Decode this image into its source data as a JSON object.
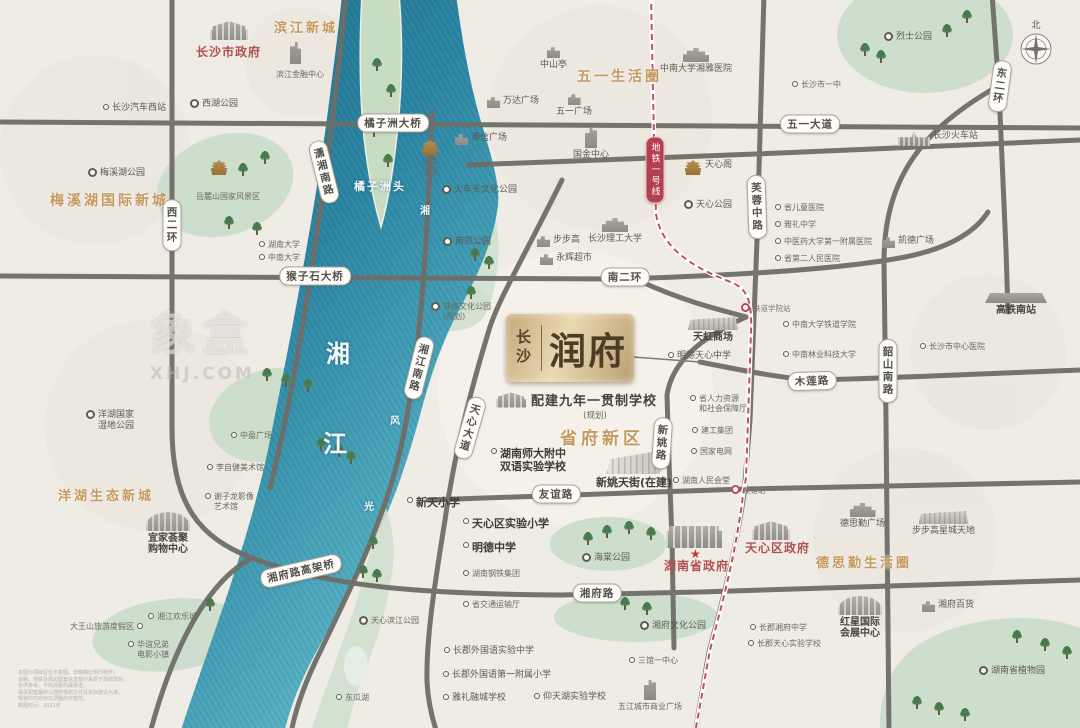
{
  "map": {
    "compass_label": "北",
    "watermark": {
      "line1": "象盒",
      "line2": "XHJ.COM"
    },
    "metro_badge": {
      "label": "地铁一号线",
      "x": 655,
      "y": 170
    },
    "project": {
      "city": "长沙",
      "name": "润府",
      "school_note": "配建九年一贯制学校",
      "school_note_sub": "(规划)",
      "district": "省府新区"
    },
    "colors": {
      "accent_gold": "#c49a5e",
      "gov_red": "#b05252",
      "road_gray": "#6f6d68",
      "river_deep": "#1b6c89",
      "river_light": "#63bccb",
      "park_green": "#cddfcc",
      "metro_red": "#c34f5e",
      "logo_gold": "#ead9b2"
    },
    "area_labels": [
      {
        "t": "滨江新城",
        "x": 274,
        "y": 17,
        "fs": 13
      },
      {
        "t": "五一生活圈",
        "x": 577,
        "y": 66,
        "fs": 14
      },
      {
        "t": "梅溪湖国际新城",
        "x": 50,
        "y": 190,
        "fs": 14
      },
      {
        "t": "洋湖生态新城",
        "x": 58,
        "y": 485,
        "fs": 13
      },
      {
        "t": "德思勤生活圈",
        "x": 816,
        "y": 552,
        "fs": 13
      }
    ],
    "river_labels": [
      {
        "t": "湘",
        "x": 326,
        "y": 334,
        "fs": 24
      },
      {
        "t": "江",
        "x": 323,
        "y": 424,
        "fs": 24
      },
      {
        "t": "橘子洲头",
        "x": 354,
        "y": 178,
        "fs": 11
      },
      {
        "t": "湘",
        "x": 420,
        "y": 202,
        "fs": 10
      },
      {
        "t": "风",
        "x": 390,
        "y": 412,
        "fs": 10
      },
      {
        "t": "光",
        "x": 364,
        "y": 498,
        "fs": 10
      }
    ],
    "road_pills": [
      {
        "t": "西二环",
        "x": 172,
        "y": 225,
        "v": 1,
        "r": 0
      },
      {
        "t": "潇湘南路",
        "x": 324,
        "y": 172,
        "v": 1,
        "r": -14
      },
      {
        "t": "橘子洲大桥",
        "x": 393,
        "y": 123,
        "v": 0,
        "r": 0
      },
      {
        "t": "五一大道",
        "x": 810,
        "y": 124,
        "v": 0,
        "r": 0
      },
      {
        "t": "东二环",
        "x": 1000,
        "y": 86,
        "v": 1,
        "r": 8
      },
      {
        "t": "芙蓉中路",
        "x": 757,
        "y": 207,
        "v": 1,
        "r": -2
      },
      {
        "t": "南二环",
        "x": 625,
        "y": 277,
        "v": 0,
        "r": 0
      },
      {
        "t": "猴子石大桥",
        "x": 315,
        "y": 276,
        "v": 0,
        "r": 0
      },
      {
        "t": "湘江南路",
        "x": 419,
        "y": 368,
        "v": 1,
        "r": 14
      },
      {
        "t": "天心大道",
        "x": 470,
        "y": 428,
        "v": 1,
        "r": 16
      },
      {
        "t": "木莲路",
        "x": 812,
        "y": 381,
        "v": 0,
        "r": -2
      },
      {
        "t": "韶山南路",
        "x": 888,
        "y": 371,
        "v": 1,
        "r": 0
      },
      {
        "t": "新姚路",
        "x": 662,
        "y": 443,
        "v": 1,
        "r": 4
      },
      {
        "t": "友谊路",
        "x": 556,
        "y": 494,
        "v": 0,
        "r": 0
      },
      {
        "t": "湘府路",
        "x": 597,
        "y": 593,
        "v": 0,
        "r": 0
      },
      {
        "t": "湘府路高架桥",
        "x": 301,
        "y": 571,
        "v": 0,
        "r": -13
      }
    ],
    "pois": [
      {
        "t": "长沙市政府",
        "x": 196,
        "y": 47,
        "cls": "red12"
      },
      {
        "t": "",
        "x": 210,
        "y": 20,
        "ic": "gov"
      },
      {
        "t": "滨江金融中心",
        "x": 276,
        "y": 70,
        "cls": "sm"
      },
      {
        "t": "",
        "x": 290,
        "y": 42,
        "ic": "tower2"
      },
      {
        "t": "长沙汽车西站",
        "x": 103,
        "y": 103,
        "mk": "dot"
      },
      {
        "t": "西湖公园",
        "x": 190,
        "y": 99,
        "mk": "ring"
      },
      {
        "t": "梅溪湖公园",
        "x": 88,
        "y": 168,
        "mk": "ring"
      },
      {
        "t": "岳麓山国家风景区",
        "x": 196,
        "y": 192,
        "cls": "sm"
      },
      {
        "t": "",
        "x": 210,
        "y": 160,
        "ic": "temple"
      },
      {
        "t": "湖南大学",
        "x": 259,
        "y": 240,
        "mk": "dot",
        "cls": "sm"
      },
      {
        "t": "中南大学",
        "x": 259,
        "y": 253,
        "mk": "dot",
        "cls": "sm"
      },
      {
        "t": "中山亭",
        "x": 540,
        "y": 46,
        "ic": "bld",
        "ly": "col"
      },
      {
        "t": "五一广场",
        "x": 556,
        "y": 93,
        "ic": "bld",
        "ly": "col"
      },
      {
        "t": "万达广场",
        "x": 487,
        "y": 96,
        "mk": "bld"
      },
      {
        "t": "海信广场",
        "x": 455,
        "y": 133,
        "mk": "bld"
      },
      {
        "t": "国金中心",
        "x": 573,
        "y": 128,
        "ic": "tower",
        "ly": "col"
      },
      {
        "t": "中南大学湘雅医院",
        "x": 660,
        "y": 48,
        "ic": "bldw",
        "ly": "col"
      },
      {
        "t": "烈士公园",
        "x": 884,
        "y": 32,
        "mk": "ring"
      },
      {
        "t": "长沙市一中",
        "x": 792,
        "y": 80,
        "mk": "dot",
        "cls": "sm"
      },
      {
        "t": "长沙火车站",
        "x": 898,
        "y": 131,
        "mk": "train"
      },
      {
        "t": "凯德广场",
        "x": 882,
        "y": 236,
        "mk": "bld"
      },
      {
        "t": "天心阁",
        "x": 684,
        "y": 160,
        "mk": "temple"
      },
      {
        "t": "天心公园",
        "x": 684,
        "y": 200,
        "mk": "ring"
      },
      {
        "t": "省儿童医院",
        "x": 775,
        "y": 203,
        "mk": "dot",
        "cls": "sm"
      },
      {
        "t": "雅礼中学",
        "x": 775,
        "y": 220,
        "mk": "dot",
        "cls": "sm"
      },
      {
        "t": "中医药大学第一附属医院",
        "x": 775,
        "y": 237,
        "mk": "dot",
        "cls": "sm"
      },
      {
        "t": "省第二人民医院",
        "x": 775,
        "y": 254,
        "mk": "dot",
        "cls": "sm"
      },
      {
        "t": "杜甫\n江阁",
        "x": 421,
        "y": 140,
        "ic": "temple",
        "ly": "col",
        "cls": "sm"
      },
      {
        "t": "火车头文化公园",
        "x": 442,
        "y": 185,
        "mk": "ring"
      },
      {
        "t": "南郊公园",
        "x": 443,
        "y": 237,
        "mk": "ring"
      },
      {
        "t": "步步高",
        "x": 537,
        "y": 235,
        "mk": "bld"
      },
      {
        "t": "永辉超市",
        "x": 540,
        "y": 253,
        "mk": "bld"
      },
      {
        "t": "长沙理工大学",
        "x": 588,
        "y": 218,
        "ic": "bldw",
        "ly": "col"
      },
      {
        "t": "铁道学院站",
        "x": 741,
        "y": 303,
        "mk": "metro",
        "cls": "xs"
      },
      {
        "t": "中南大学铁道学院",
        "x": 783,
        "y": 320,
        "mk": "dot",
        "cls": "sm"
      },
      {
        "t": "中南林业科技大学",
        "x": 783,
        "y": 350,
        "mk": "dot",
        "cls": "sm"
      },
      {
        "t": "长沙市中心医院",
        "x": 920,
        "y": 342,
        "mk": "dot",
        "cls": "sm"
      },
      {
        "t": "高铁南站",
        "x": 985,
        "y": 293,
        "ic": "flat",
        "ly": "col",
        "cls": "mdb"
      },
      {
        "t": "天虹商场",
        "x": 688,
        "y": 317,
        "ic": "mallw",
        "ly": "col",
        "cls": "mdb"
      },
      {
        "t": "明德天心中学",
        "x": 668,
        "y": 351,
        "mk": "dot"
      },
      {
        "t": "省人力资源\n和社会保障厅",
        "x": 690,
        "y": 394,
        "mk": "dot",
        "cls": "sm"
      },
      {
        "t": "建工集团",
        "x": 692,
        "y": 426,
        "mk": "dot",
        "cls": "sm"
      },
      {
        "t": "国家电网",
        "x": 691,
        "y": 447,
        "mk": "dot",
        "cls": "sm"
      },
      {
        "t": "湖南人民会堂",
        "x": 673,
        "y": 476,
        "mk": "dot",
        "cls": "sm"
      },
      {
        "t": "铁路文化公园\n(规划)",
        "x": 431,
        "y": 302,
        "mk": "ring",
        "cls": "sm"
      },
      {
        "t": "湖南师大附中\n双语实验学校",
        "x": 491,
        "y": 447,
        "mk": "dot",
        "cls": "big"
      },
      {
        "t": "新姚天街(在建)",
        "x": 596,
        "y": 452,
        "ic": "mall",
        "ly": "col",
        "cls": "big"
      },
      {
        "t": "中盈广场",
        "x": 231,
        "y": 431,
        "mk": "dot",
        "cls": "sm"
      },
      {
        "t": "李自健美术馆",
        "x": 207,
        "y": 463,
        "mk": "dot",
        "cls": "sm"
      },
      {
        "t": "洋湖国家\n湿地公园",
        "x": 86,
        "y": 410,
        "mk": "ring"
      },
      {
        "t": "谢子龙影像\n艺术馆",
        "x": 205,
        "y": 492,
        "mk": "dot",
        "cls": "sm"
      },
      {
        "t": "宜家荟聚\n购物中心",
        "x": 146,
        "y": 512,
        "ic": "ikea",
        "ly": "col",
        "cls": "mdb"
      },
      {
        "t": "大王山旅游度假区",
        "x": 70,
        "y": 622,
        "mk": "dot",
        "rev": 1,
        "cls": "sm"
      },
      {
        "t": "湘江欢乐城",
        "x": 148,
        "y": 612,
        "mk": "dot",
        "cls": "sm"
      },
      {
        "t": "华谊兄弟\n电影小镇",
        "x": 128,
        "y": 640,
        "mk": "dot",
        "cls": "sm"
      },
      {
        "t": "天心滨江公园",
        "x": 359,
        "y": 616,
        "mk": "ring",
        "cls": "sm"
      },
      {
        "t": "新天小学",
        "x": 407,
        "y": 496,
        "mk": "dot",
        "cls": "big"
      },
      {
        "t": "天心区实验小学",
        "x": 463,
        "y": 517,
        "mk": "dot",
        "cls": "big"
      },
      {
        "t": "明德中学",
        "x": 463,
        "y": 541,
        "mk": "dot",
        "cls": "big"
      },
      {
        "t": "湖南钢铁集团",
        "x": 463,
        "y": 569,
        "mk": "dot",
        "cls": "sm"
      },
      {
        "t": "省交通运输厅",
        "x": 463,
        "y": 600,
        "mk": "dot",
        "cls": "sm"
      },
      {
        "t": "海棠公园",
        "x": 582,
        "y": 553,
        "mk": "ring"
      },
      {
        "t": "",
        "x": 666,
        "y": 526,
        "ic": "govw"
      },
      {
        "t": "★",
        "x": 690,
        "y": 549,
        "cls": "star"
      },
      {
        "t": "湖南省政府",
        "x": 664,
        "y": 561,
        "cls": "red12"
      },
      {
        "t": "",
        "x": 752,
        "y": 520,
        "ic": "gov"
      },
      {
        "t": "天心区政府",
        "x": 745,
        "y": 543,
        "cls": "red12"
      },
      {
        "t": "长郡外国语实验中学",
        "x": 444,
        "y": 646,
        "mk": "dot"
      },
      {
        "t": "长郡外国语第一附属小学",
        "x": 443,
        "y": 670,
        "mk": "dot"
      },
      {
        "t": "雅礼融城学校",
        "x": 443,
        "y": 693,
        "mk": "dot"
      },
      {
        "t": "仰天湖实验学校",
        "x": 534,
        "y": 692,
        "mk": "dot"
      },
      {
        "t": "三馆一中心",
        "x": 629,
        "y": 656,
        "mk": "dot",
        "cls": "sm"
      },
      {
        "t": "五江城市商业广场",
        "x": 618,
        "y": 680,
        "ic": "tower",
        "ly": "col",
        "cls": "sm"
      },
      {
        "t": "湘府文化公园",
        "x": 640,
        "y": 621,
        "mk": "ring"
      },
      {
        "t": "东瓜湖",
        "x": 336,
        "y": 693,
        "mk": "dot",
        "cls": "sm"
      },
      {
        "t": "友谊站",
        "x": 731,
        "y": 485,
        "mk": "metro",
        "cls": "xs"
      },
      {
        "t": "德思勤广场",
        "x": 840,
        "y": 503,
        "ic": "bldw",
        "ly": "col"
      },
      {
        "t": "步步高星城天地",
        "x": 912,
        "y": 511,
        "ic": "mallw",
        "ly": "col"
      },
      {
        "t": "红星国际\n会展中心",
        "x": 838,
        "y": 596,
        "ic": "ikea",
        "ly": "col",
        "cls": "mdb"
      },
      {
        "t": "湘府百货",
        "x": 922,
        "y": 600,
        "mk": "bld"
      },
      {
        "t": "长郡湘府中学",
        "x": 750,
        "y": 623,
        "mk": "dot",
        "cls": "sm"
      },
      {
        "t": "长郡天心实验学校",
        "x": 748,
        "y": 639,
        "mk": "dot",
        "cls": "sm"
      },
      {
        "t": "湖南省植物园",
        "x": 979,
        "y": 666,
        "mk": "ring"
      }
    ],
    "trees": [
      [
        372,
        58
      ],
      [
        386,
        84
      ],
      [
        369,
        124
      ],
      [
        383,
        154
      ],
      [
        260,
        151
      ],
      [
        238,
        163
      ],
      [
        224,
        216
      ],
      [
        252,
        222
      ],
      [
        860,
        43
      ],
      [
        876,
        50
      ],
      [
        942,
        24
      ],
      [
        962,
        10
      ],
      [
        470,
        248
      ],
      [
        484,
        256
      ],
      [
        466,
        286
      ],
      [
        583,
        532
      ],
      [
        602,
        525
      ],
      [
        624,
        521
      ],
      [
        646,
        527
      ],
      [
        316,
        438
      ],
      [
        334,
        444
      ],
      [
        346,
        451
      ],
      [
        262,
        368
      ],
      [
        281,
        374
      ],
      [
        303,
        379
      ],
      [
        358,
        565
      ],
      [
        372,
        569
      ],
      [
        368,
        536
      ],
      [
        205,
        598
      ],
      [
        1012,
        630
      ],
      [
        1040,
        638
      ],
      [
        1062,
        646
      ],
      [
        912,
        696
      ],
      [
        934,
        702
      ],
      [
        960,
        708
      ],
      [
        620,
        597
      ],
      [
        642,
        602
      ]
    ],
    "disclaimer": [
      "本图为项目区位示意图，非精确比例尺制作，",
      "道路、地铁及周边配套信息部分来源于政府规划，",
      "仅供参考，不构成要约或承诺，",
      "相关配套最终以政府规划文件及实际建设为准，",
      "规划中内容存在调整的可能性。",
      "制图时间：2021年"
    ]
  }
}
